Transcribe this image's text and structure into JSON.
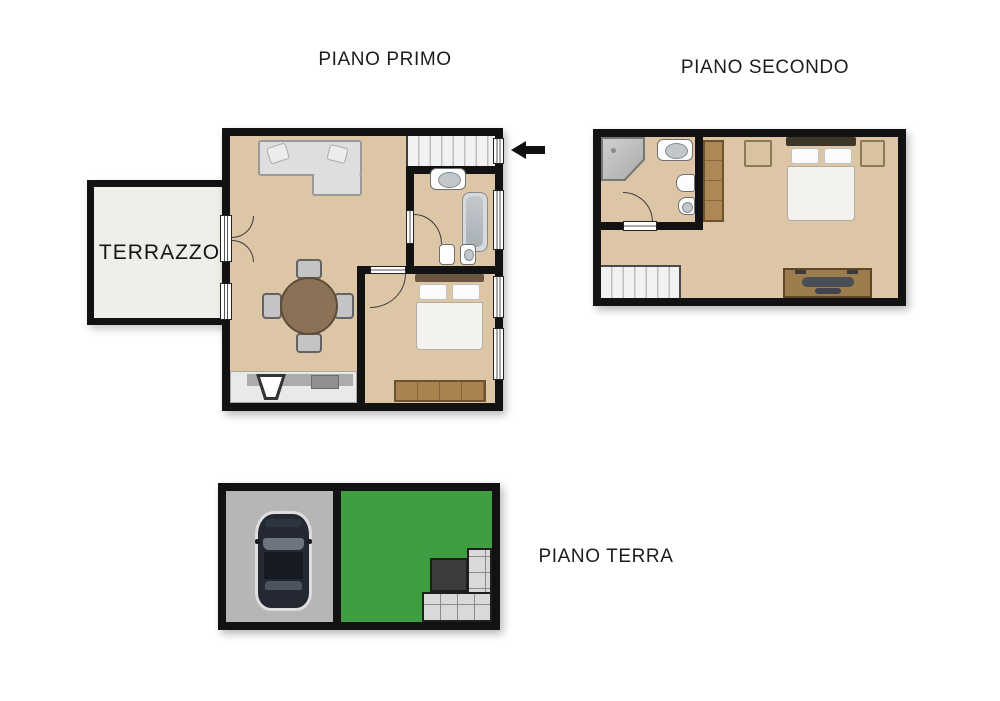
{
  "labels": {
    "first_floor": "PIANO PRIMO",
    "second_floor": "PIANO SECONDO",
    "ground_floor": "PIANO TERRA",
    "terrace": "TERRAZZO"
  },
  "colors": {
    "background": "#ffffff",
    "wall": "#121212",
    "floor": "#dcc6a6",
    "terrace_floor": "#efeee9",
    "stairs": "#f2f2f2",
    "garden": "#3f9e41",
    "garage": "#b6b6b6",
    "paving": "#d9d9d9",
    "landing": "#3c3c3c",
    "wood": "#a9824f",
    "arrow": "#111111",
    "text": "#1c1c1c"
  },
  "floors": [
    {
      "name": "piano-primo",
      "rooms": [
        "living-dining-room",
        "kitchen-area",
        "bathroom",
        "bedroom",
        "staircase",
        "terrace"
      ],
      "furniture": [
        "corner-sofa",
        "round-dining-table",
        "dining-chairs",
        "kitchen-counter",
        "kitchen-sink",
        "cooktop",
        "double-bed",
        "wardrobe",
        "washbasin",
        "bathtub",
        "toilet",
        "bidet"
      ]
    },
    {
      "name": "piano-secondo",
      "rooms": [
        "bedroom",
        "bathroom",
        "landing"
      ],
      "furniture": [
        "double-bed",
        "nightstand-left",
        "nightstand-right",
        "wardrobe",
        "desk",
        "desk-chair",
        "corner-shower",
        "washbasin",
        "toilet",
        "bidet",
        "staircase"
      ]
    },
    {
      "name": "piano-terra",
      "rooms": [
        "garage",
        "garden"
      ],
      "furniture": [
        "car",
        "paved-steps",
        "landing-slab"
      ]
    }
  ],
  "annotations": {
    "entrance_arrow_direction": "left"
  }
}
